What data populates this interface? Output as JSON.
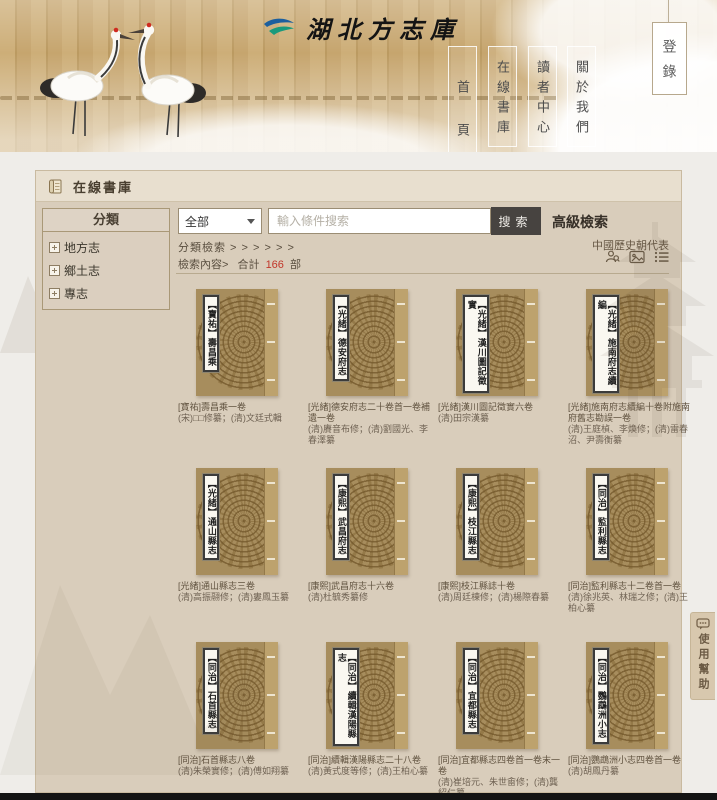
{
  "header": {
    "site_title": "湖北方志庫",
    "nav": [
      {
        "label": "首頁"
      },
      {
        "label": "在線書庫"
      },
      {
        "label": "讀者中心"
      },
      {
        "label": "關於我們"
      }
    ],
    "login_label": "登錄"
  },
  "page": {
    "section_title": "在線書庫",
    "help_button": "使用幫助"
  },
  "sidebar": {
    "title": "分類",
    "items": [
      {
        "label": "地方志"
      },
      {
        "label": "鄉土志"
      },
      {
        "label": "專志"
      }
    ]
  },
  "search": {
    "category_selected": "全部",
    "placeholder": "輸入條件搜索",
    "search_label": "搜索",
    "advanced_label": "高級檢索",
    "dynasty_link": "中國歷史朝代表",
    "breadcrumb": "分類檢索 > > > > > >",
    "result_prefix": "檢索內容>",
    "total_label": "合計",
    "total_count": "166",
    "total_unit": "部",
    "icons": [
      "person-search-icon",
      "image-view-icon",
      "list-view-icon"
    ]
  },
  "books": [
    {
      "spine": "【寶祐】壽昌乘",
      "title": "[寶祐]壽昌乘一卷",
      "authors": "(宋)□□修纂；(清)文廷式輯"
    },
    {
      "spine": "【光緒】德安府志",
      "title": "[光緒]德安府志二十卷首一卷補遺一卷",
      "authors": "(清)賡音布修；(清)劉國光、李春澤纂"
    },
    {
      "spine": "【光緒】漢川圖記徵實",
      "title": "[光緒]漢川圖記徵實六卷",
      "authors": "(清)田宗漢纂"
    },
    {
      "spine": "【光緒】施南府志續編",
      "title": "[光緒]施南府志續編十卷附施南府舊志勘誤一卷",
      "authors": "(清)王庭楨、李煥修；(清)雷春沼、尹壽衡纂"
    },
    {
      "spine": "【光緒】通山縣志",
      "title": "[光緒]通山縣志三卷",
      "authors": "(清)高振翮修；(清)婁鳳玉纂"
    },
    {
      "spine": "【康熙】武昌府志",
      "title": "[康熙]武昌府志十六卷",
      "authors": "(清)杜毓秀纂修"
    },
    {
      "spine": "【康熙】枝江縣志",
      "title": "[康熙]枝江縣誌十卷",
      "authors": "(清)周廷棟修；(清)楊際春纂"
    },
    {
      "spine": "【同治】監利縣志",
      "title": "[同治]監利縣志十二卷首一卷",
      "authors": "(清)徐兆英、林瑞之修；(清)王柏心纂"
    },
    {
      "spine": "【同治】石首縣志",
      "title": "[同治]石首縣志八卷",
      "authors": "(清)朱榮實修；(清)傅如翔纂"
    },
    {
      "spine": "【同治】續輯漢陽縣志",
      "title": "[同治]續輯漢陽縣志二十八卷",
      "authors": "(清)黃式度等修；(清)王柏心纂"
    },
    {
      "spine": "【同治】宜都縣志",
      "title": "[同治]宜都縣志四卷首一卷末一卷",
      "authors": "(清)崔培元、朱世畬修；(清)龔紹仁纂"
    },
    {
      "spine": "【同治】鸚鵡洲小志",
      "title": "[同治]鸚鵡洲小志四卷首一卷",
      "authors": "(清)胡鳳丹纂"
    }
  ],
  "colors": {
    "header_slat": "#c6a56e",
    "panel_bg": "#d9cdbb",
    "search_button_bg": "#474340",
    "count_red": "#c2372a",
    "book_cover": "#a78d5d",
    "logo_blue": "#1c5f9e",
    "logo_green": "#1a9a7c",
    "crane_crown": "#cf2b20"
  }
}
